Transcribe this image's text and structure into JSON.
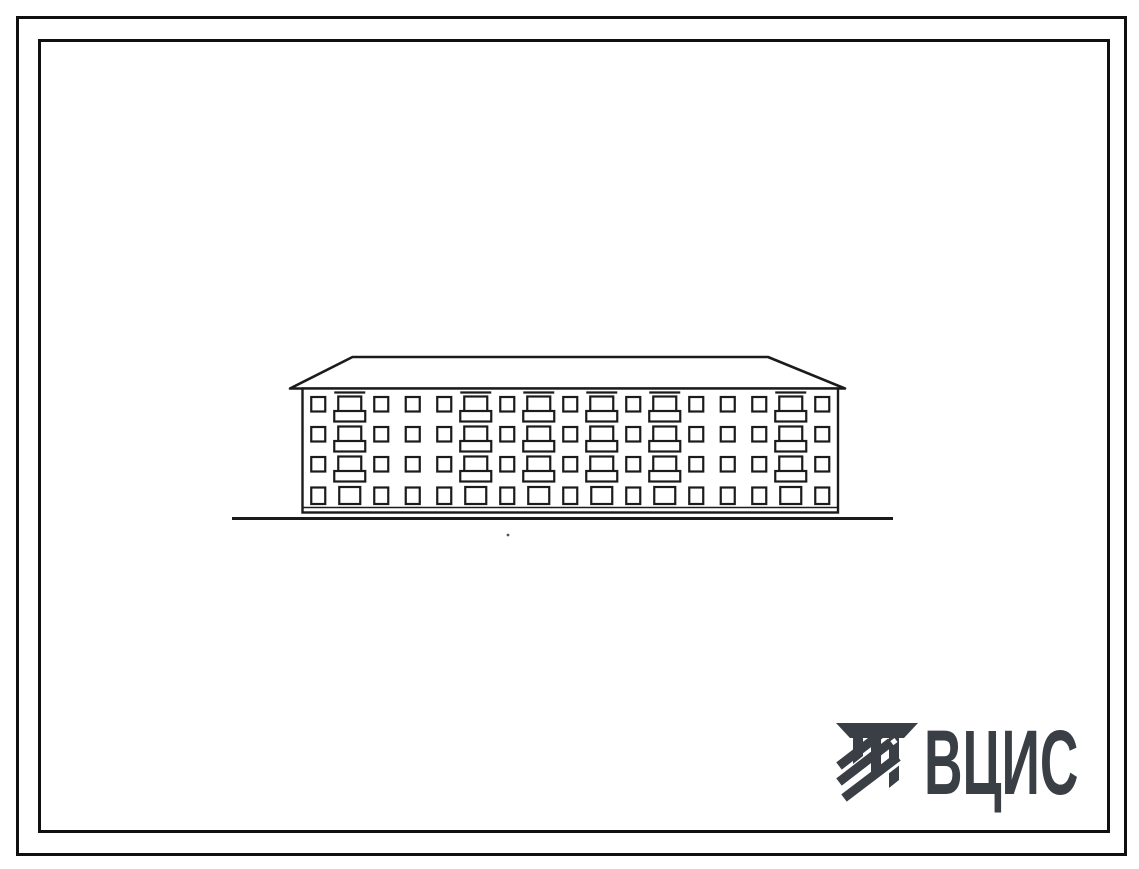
{
  "page": {
    "background": "#ffffff",
    "frame_color": "#101010"
  },
  "drawing": {
    "type": "building-facade-elevation",
    "floors": 4,
    "window_columns": 17,
    "balcony_columns": [
      2,
      6,
      8,
      10,
      12,
      16
    ],
    "line_color": "#1b1b1b"
  },
  "logo": {
    "text": "ВЦИС",
    "color": "#3a3e45"
  }
}
